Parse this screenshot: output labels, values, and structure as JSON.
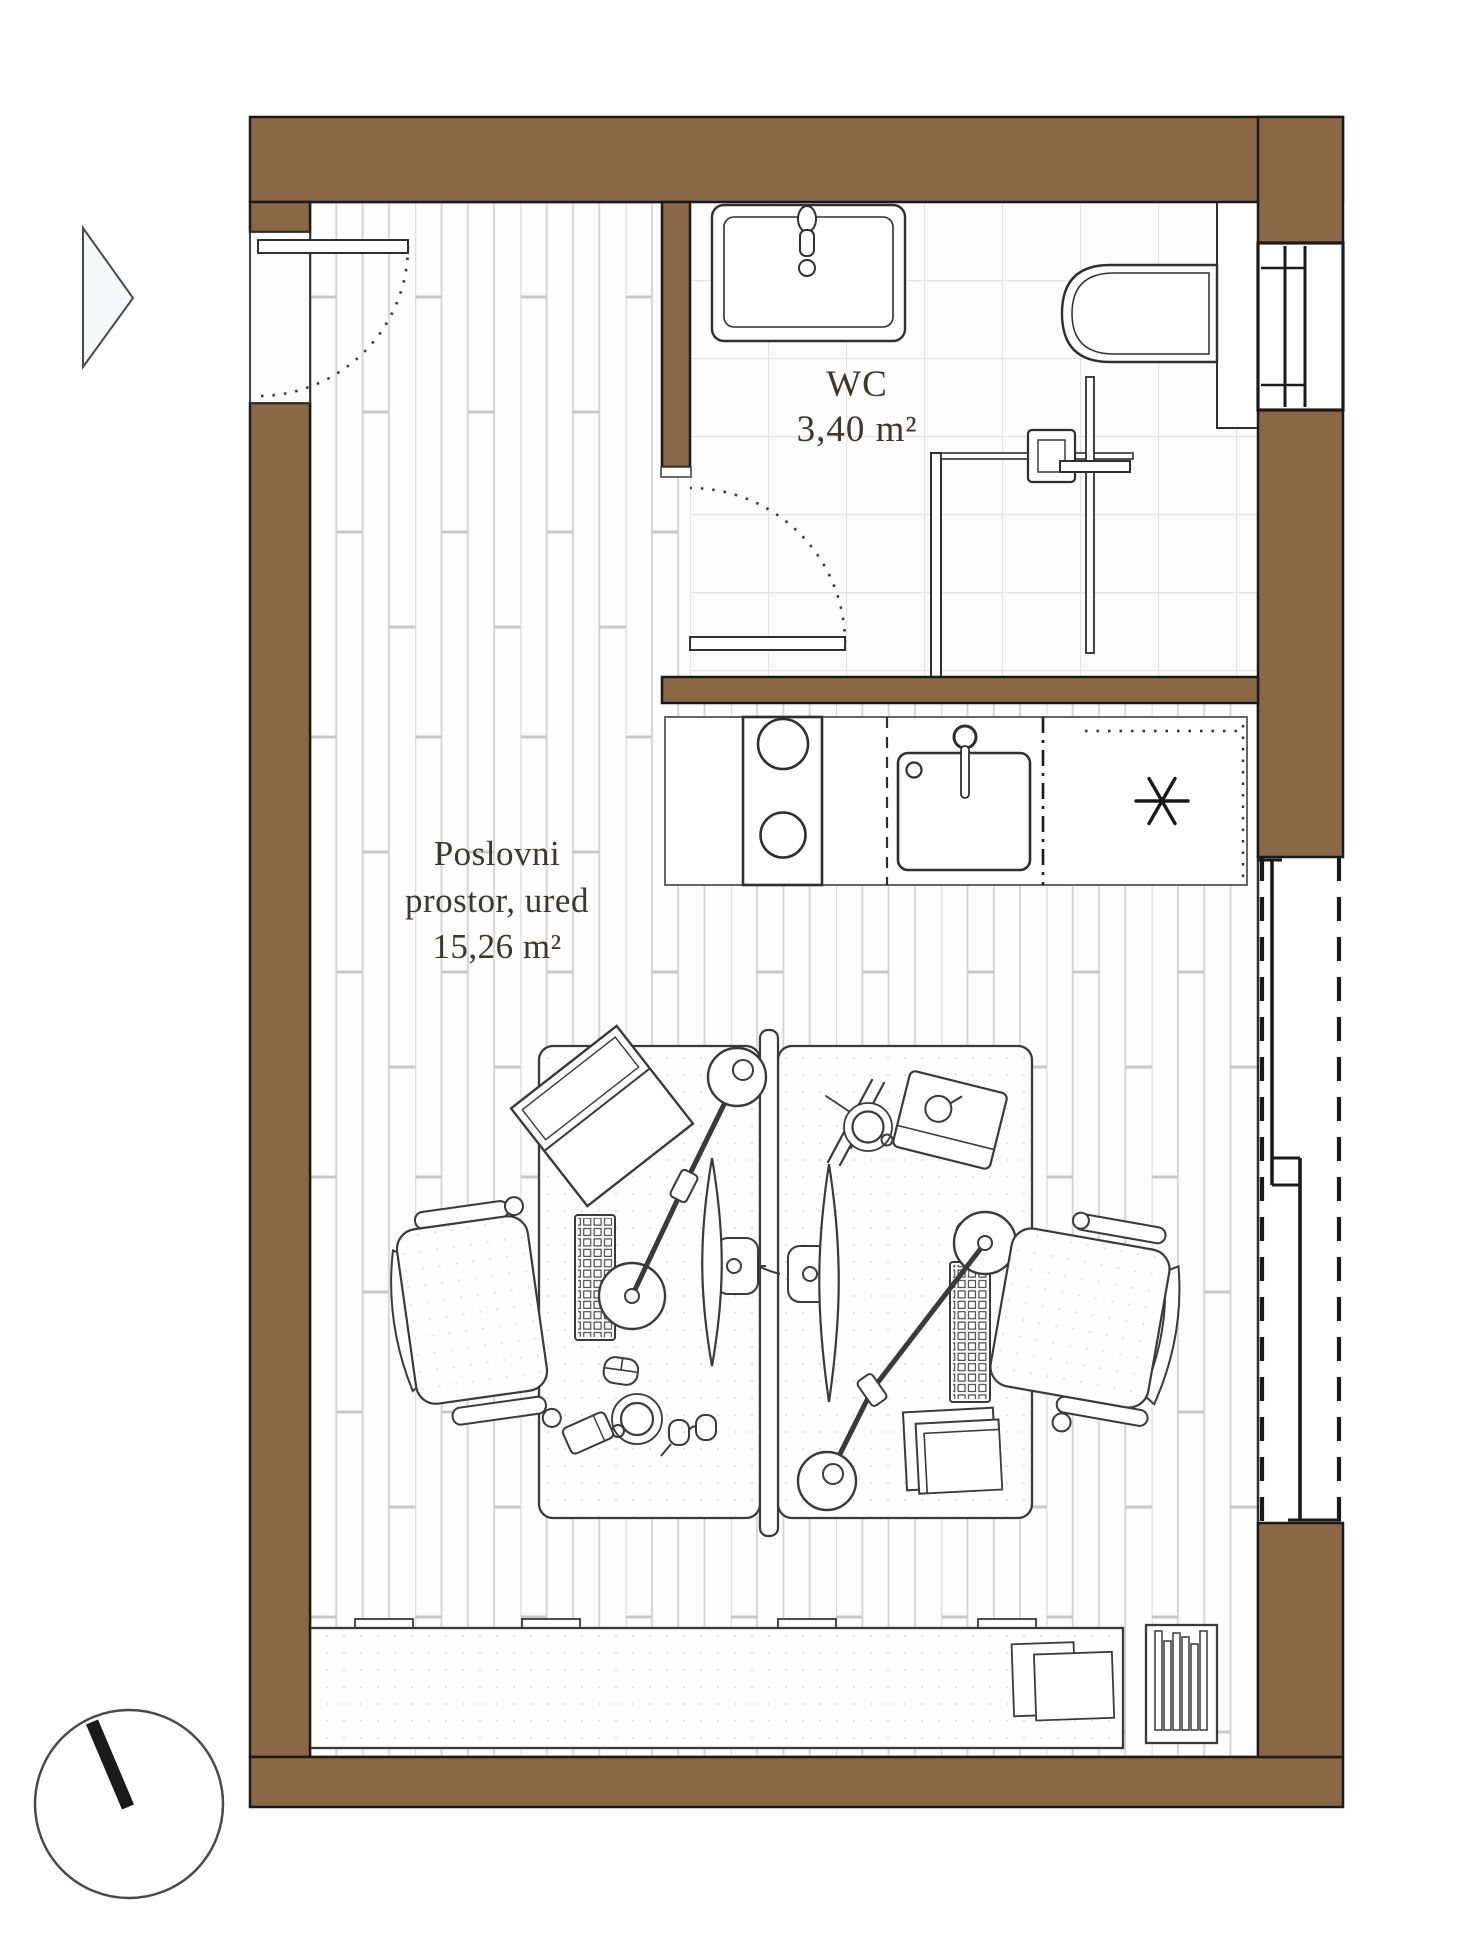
{
  "rooms": {
    "office": {
      "label_line1": "Poslovni",
      "label_line2": "prostor, ured",
      "area": "15,26 m²"
    },
    "wc": {
      "label": "WC",
      "area": "3,40 m²"
    }
  },
  "kitchen": {
    "appliance_marker": "*"
  },
  "symbols": {
    "entrance_arrow": "right-pointing-triangle",
    "north_compass": "circle-with-needle"
  },
  "colors": {
    "wall_brown": "#8a6746",
    "outline_black": "#1a1a1a",
    "line_dark": "#2f2f2f",
    "plank_line": "#d6d6d6",
    "tile_line": "#e3e3e3",
    "label_text": "#3b3734"
  }
}
